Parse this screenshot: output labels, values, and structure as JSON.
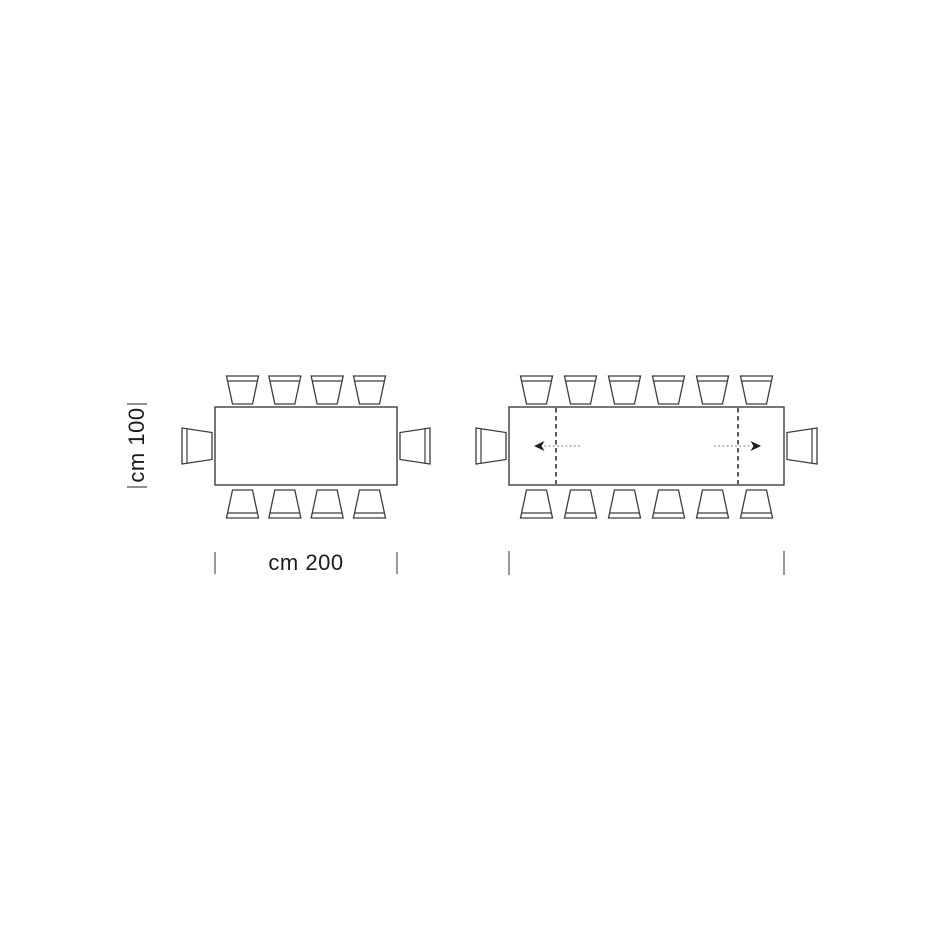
{
  "page": {
    "background_color": "#ffffff"
  },
  "style": {
    "line_color": "#3d3d3d",
    "table_fill": "#ffffff",
    "extension_dash_color": "#262626",
    "arrow_shaft_color": "#9a9a9a",
    "arrow_head_color": "#1c1c1c",
    "tick_color": "#6b6b6b",
    "text_color": "#1c1c1c"
  },
  "labels": {
    "depth": "cm 100",
    "width": "cm 200"
  },
  "chair_metrics": {
    "back_width": 32,
    "front_width": 20,
    "depth": 28,
    "side_back_height": 36,
    "side_front_height": 27,
    "side_depth": 30,
    "gap_top": 3,
    "gap_bottom": 5,
    "gap_side": 3,
    "row_margin": 27.5,
    "back_line_inset": 5
  },
  "diagrams": [
    {
      "name": "table-closed-plan",
      "seats": 10,
      "table": {
        "x": 215,
        "y": 407,
        "w": 182,
        "h": 78
      },
      "chairs": {
        "top": 4,
        "bottom": 4,
        "left": 1,
        "right": 1
      },
      "extension_lines": [],
      "arrows": [],
      "ticks": [
        {
          "x1": 215,
          "y1": 552,
          "x2": 215,
          "y2": 574
        },
        {
          "x1": 397,
          "y1": 552,
          "x2": 397,
          "y2": 574
        },
        {
          "x1": 127,
          "y1": 404,
          "x2": 147,
          "y2": 404
        },
        {
          "x1": 127,
          "y1": 487,
          "x2": 147,
          "y2": 487
        }
      ]
    },
    {
      "name": "table-extended-plan",
      "seats": 14,
      "table": {
        "x": 509,
        "y": 407,
        "w": 275,
        "h": 78
      },
      "chairs": {
        "top": 6,
        "bottom": 6,
        "left": 1,
        "right": 1
      },
      "extension_lines": [
        556,
        738
      ],
      "arrows": [
        {
          "tip_x": 534,
          "tail_x": 580,
          "y": 446,
          "dir": "left"
        },
        {
          "tip_x": 761,
          "tail_x": 714,
          "y": 446,
          "dir": "right"
        }
      ],
      "ticks": [
        {
          "x1": 509,
          "y1": 551,
          "x2": 509,
          "y2": 575
        },
        {
          "x1": 784,
          "y1": 551,
          "x2": 784,
          "y2": 575
        }
      ]
    }
  ]
}
